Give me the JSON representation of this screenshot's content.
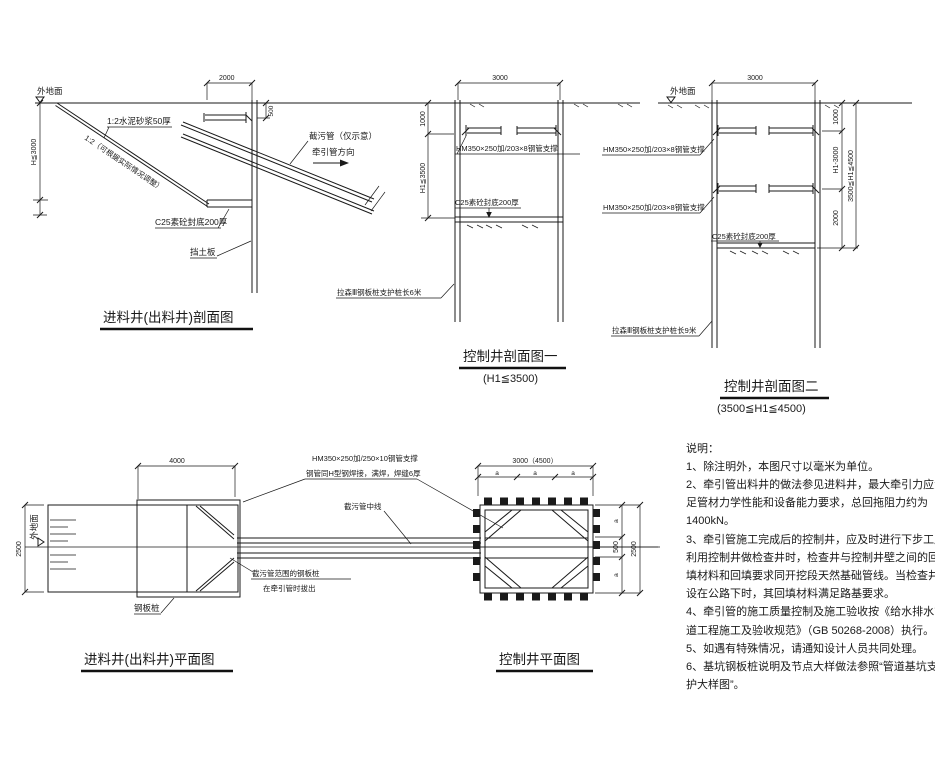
{
  "drawing": {
    "s1": {
      "title": "进料井(出料井)剖面图",
      "ground": "外地面",
      "mortar": "1:2水泥砂浆50厚",
      "slope_note": "1:2（可根据实际情况调整）",
      "pipe_note": "截污管（仅示意）",
      "direction": "牵引管方向",
      "seal": "C25素砼封底200厚",
      "board": "挡土板",
      "dim_top": "2000",
      "dim_depth": "H≦3000",
      "dim_embed": "500"
    },
    "s2": {
      "title": "控制井剖面图一",
      "subtitle": "(H1≦3500)",
      "strut": "HM350×250加/203×8钢管支撑",
      "seal": "C25素砼封底200厚",
      "pile": "拉森Ⅲ钢板桩支护桩长6米",
      "dim_width": "3000",
      "dim_1000": "1000",
      "dim_depth": "H1≦3500"
    },
    "s3": {
      "title": "控制井剖面图二",
      "subtitle": "(3500≦H1≦4500)",
      "ground": "外地面",
      "strut1": "HM350×250加/203×8钢管支撑",
      "strut2": "HM350×250加/203×8钢管支撑",
      "seal": "C25素砼封底200厚",
      "pile": "拉森Ⅲ钢板桩支护桩长9米",
      "dim_width": "3000",
      "dim_1000": "1000",
      "dim_mid": "H1-3000",
      "dim_2000": "2000",
      "dim_total": "3500≦H1≦4500"
    },
    "p1": {
      "title": "进料井(出料井)平面图",
      "ground": "外地面",
      "pile": "钢板桩",
      "strut": "HM350×250加/250×10钢管支撑",
      "weld": "钢管同H型钢焊接，满焊，焊缝6厚",
      "centerline": "截污管中线",
      "removal1": "截污管范围的钢板桩",
      "removal2": "在牵引管时拔出",
      "dim_width": "4000",
      "dim_height": "2500"
    },
    "p2": {
      "title": "控制井平面图",
      "dim_width": "3000（4500）",
      "dim_a": "a",
      "dim_500": "500",
      "dim_height": "2500"
    },
    "notes": {
      "lines": [
        "说明：",
        "1、除注明外，本图尺寸以毫米为单位。",
        "2、牵引管出料井的做法参见进料井，最大牵引力应满",
        "足管材力学性能和设备能力要求，总回拖阻力约为",
        "1400kN。",
        "3、牵引管施工完成后的控制井，应及时进行下步工序，",
        "利用控制井做检查井时，检查井与控制井壁之间的回",
        "填材料和回填要求同开挖段天然基础管线。当检查井",
        "设在公路下时，其回填材料满足路基要求。",
        "4、牵引管的施工质量控制及施工验收按《给水排水管",
        "道工程施工及验收规范》（GB 50268-2008）执行。",
        "5、如遇有特殊情况，请通知设计人员共同处理。",
        "6、基坑钢板桩说明及节点大样做法参照“管道基坑支",
        "护大样图”。"
      ]
    }
  }
}
